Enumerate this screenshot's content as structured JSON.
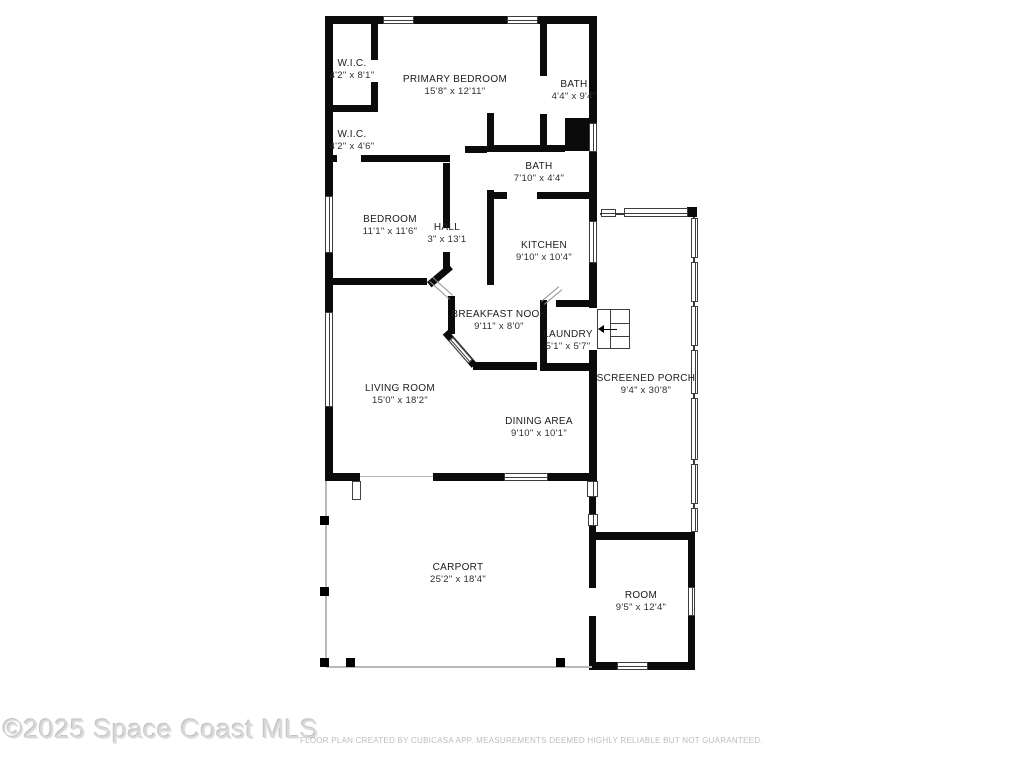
{
  "plan": {
    "watermark": "©2025 Space Coast MLS",
    "disclaimer": "FLOOR PLAN CREATED BY CUBICASA APP. MEASUREMENTS DEEMED HIGHLY RELIABLE BUT NOT GUARANTEED."
  },
  "colors": {
    "wall": "#0b0b0b",
    "background": "#ffffff",
    "watermark_text": "#d7d7d7",
    "disclaimer_text": "#bdbdbd"
  },
  "rooms": {
    "wic1": {
      "name": "W.I.C.",
      "dims": "4'2\" x 8'1\""
    },
    "primary": {
      "name": "PRIMARY BEDROOM",
      "dims": "15'8\" x 12'11\""
    },
    "bath1": {
      "name": "BATH",
      "dims": "4'4\" x 9'4\""
    },
    "wic2": {
      "name": "W.I.C.",
      "dims": "4'2\" x 4'6\""
    },
    "bath2": {
      "name": "BATH",
      "dims": "7'10\" x 4'4\""
    },
    "bedroom": {
      "name": "BEDROOM",
      "dims": "11'1\" x 11'6\""
    },
    "hall": {
      "name": "HALL",
      "dims": "3\" x 13'1"
    },
    "kitchen": {
      "name": "KITCHEN",
      "dims": "9'10\" x 10'4\""
    },
    "nook": {
      "name": "BREAKFAST NOOK",
      "dims": "9'11\" x 8'0\""
    },
    "laundry": {
      "name": "LAUNDRY",
      "dims": "5'1\" x 5'7\""
    },
    "living": {
      "name": "LIVING ROOM",
      "dims": "15'0\" x 18'2\""
    },
    "dining": {
      "name": "DINING AREA",
      "dims": "9'10\" x 10'1\""
    },
    "porch": {
      "name": "SCREENED PORCH",
      "dims": "9'4\" x 30'8\""
    },
    "carport": {
      "name": "CARPORT",
      "dims": "25'2\" x 18'4\""
    },
    "room": {
      "name": "ROOM",
      "dims": "9'5\" x 12'4\""
    }
  }
}
